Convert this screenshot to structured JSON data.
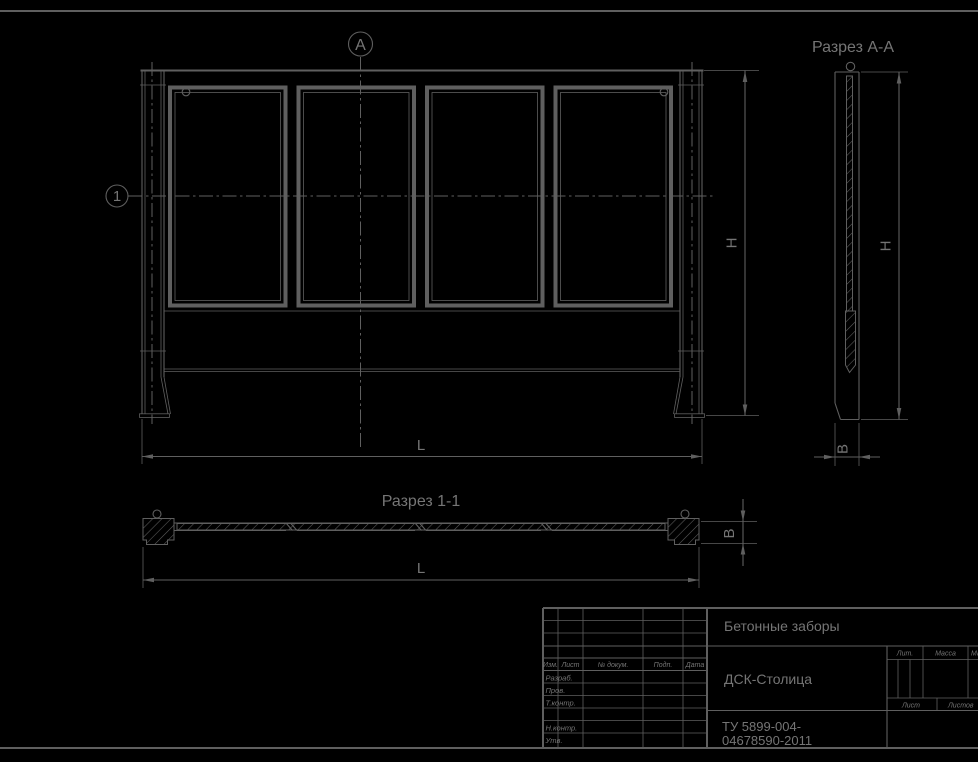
{
  "colors": {
    "background": "#000000",
    "line": "#5f5f5f",
    "text": "#757575"
  },
  "front_view": {
    "section_marker_a": "А",
    "section_marker_1": "1",
    "dim_height": "H",
    "dim_length": "L"
  },
  "section_aa": {
    "title": "Разрез А-А",
    "dim_height": "H",
    "dim_width": "В"
  },
  "section_11": {
    "title": "Разрез 1-1",
    "dim_length": "L",
    "dim_width": "В"
  },
  "title_block": {
    "product_name": "Бетонные заборы",
    "organization": "ДСК-Столица",
    "document_number_line1": "ТУ 5899-004-",
    "document_number_line2": "04678590-2011",
    "header_columns": [
      "Изм.",
      "Лист",
      "№ докум.",
      "Подп.",
      "Дата"
    ],
    "signature_rows": [
      "Разраб.",
      "Пров.",
      "Т.контр.",
      "Н.контр.",
      "Утв."
    ],
    "lit_label": "Лит.",
    "mass_label": "Масса",
    "scale_label": "Масштаб",
    "sheet_label": "Лист",
    "sheets_label": "Листов"
  }
}
